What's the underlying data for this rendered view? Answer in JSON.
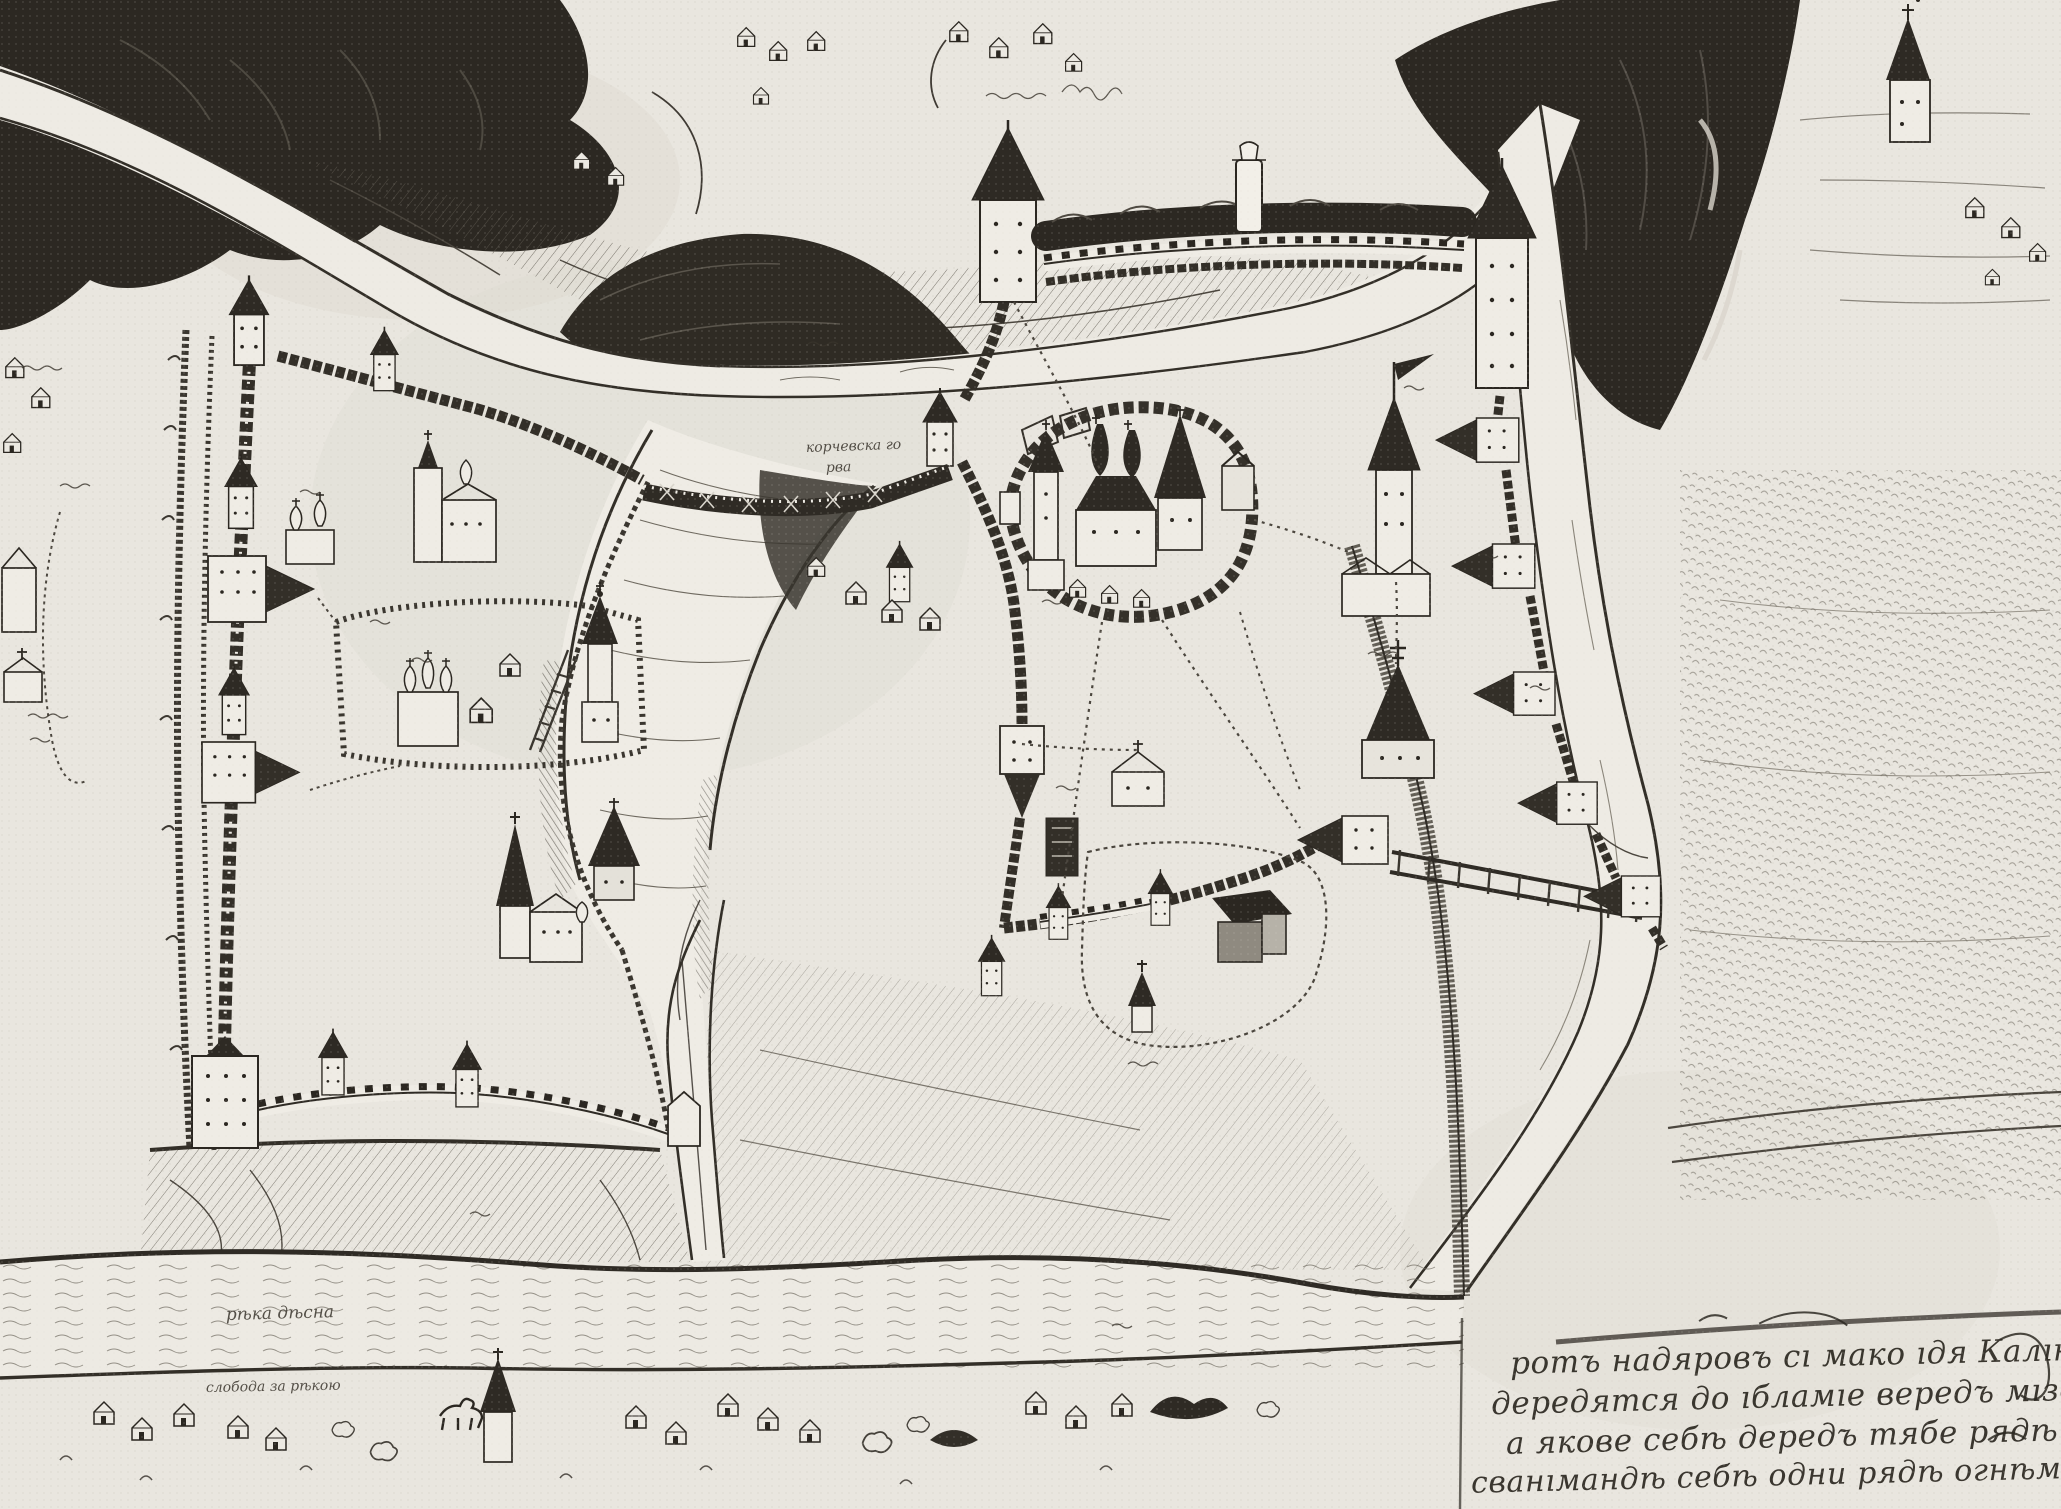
{
  "artwork": {
    "kind": "engraved-city-plan",
    "paper_color": "#e9e6df",
    "ink_color": "#2b2721"
  },
  "labels": {
    "gully_line1": "корчевска го",
    "gully_line2": "рва",
    "river_bottom": "рѣка дѣсна",
    "shore_settlement": "слобода за рѣкою"
  },
  "inscription": {
    "lines": [
      "ротъ надяровъ сı мако ıдя Калıновъ гдѣ",
      "дередятся до ıбламıе вередъ мıзе адъ",
      "а якове себѣ дередъ тябе рядѣ",
      "сванıмандѣ себѣ одни рядѣ огнѣмъ"
    ]
  }
}
